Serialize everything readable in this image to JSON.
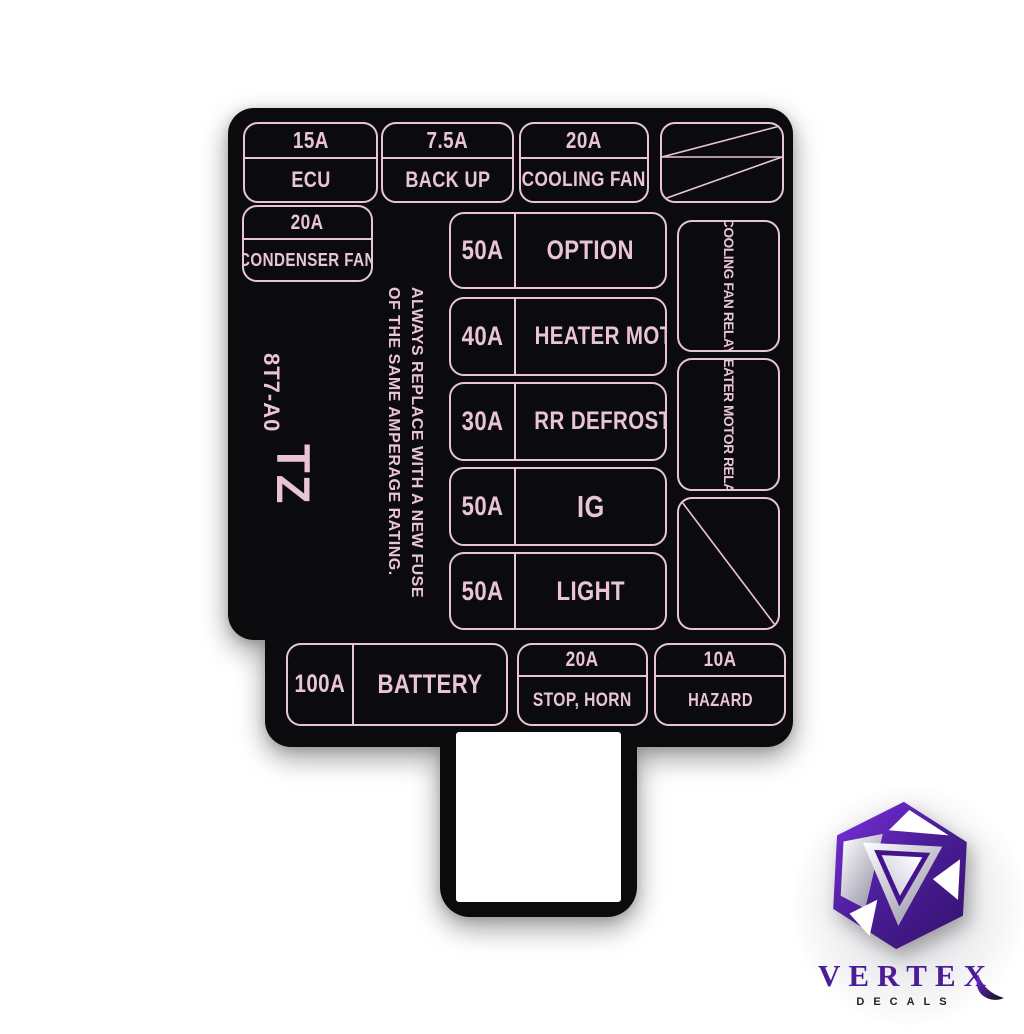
{
  "colors": {
    "pink": "#e9c4d6",
    "decal_black": "#0b0b0d",
    "logo_purple": "#4a1d96",
    "logo_sub_dark": "#222228",
    "background": "#ffffff"
  },
  "decal": {
    "part_code": "8T7-A0",
    "model_code": "TZ",
    "warning_line1": "ALWAYS REPLACE WITH A NEW FUSE",
    "warning_line2": "OF THE SAME AMPERAGE RATING.",
    "top_row": [
      {
        "amp": "15A",
        "label": "ECU"
      },
      {
        "amp": "7.5A",
        "label": "BACK UP"
      },
      {
        "amp": "20A",
        "label": "COOLING FAN"
      }
    ],
    "condenser": {
      "amp": "20A",
      "label": "CONDENSER FAN"
    },
    "main_column": [
      {
        "amp": "50A",
        "label": "OPTION"
      },
      {
        "amp": "40A",
        "label": "HEATER MOTOR"
      },
      {
        "amp": "30A",
        "label": "RR DEFROSTER"
      },
      {
        "amp": "50A",
        "label": "IG"
      },
      {
        "amp": "50A",
        "label": "LIGHT"
      }
    ],
    "relay_column": [
      {
        "label": "COOLING FAN RELAY"
      },
      {
        "label": "HEATER MOTOR RELAY"
      }
    ],
    "bottom_row": [
      {
        "amp": "100A",
        "label": "BATTERY"
      },
      {
        "amp": "20A",
        "label": "STOP, HORN"
      },
      {
        "amp": "10A",
        "label": "HAZARD"
      }
    ]
  },
  "watermark": {
    "brand": "VERTEX",
    "sub": "DECALS"
  }
}
